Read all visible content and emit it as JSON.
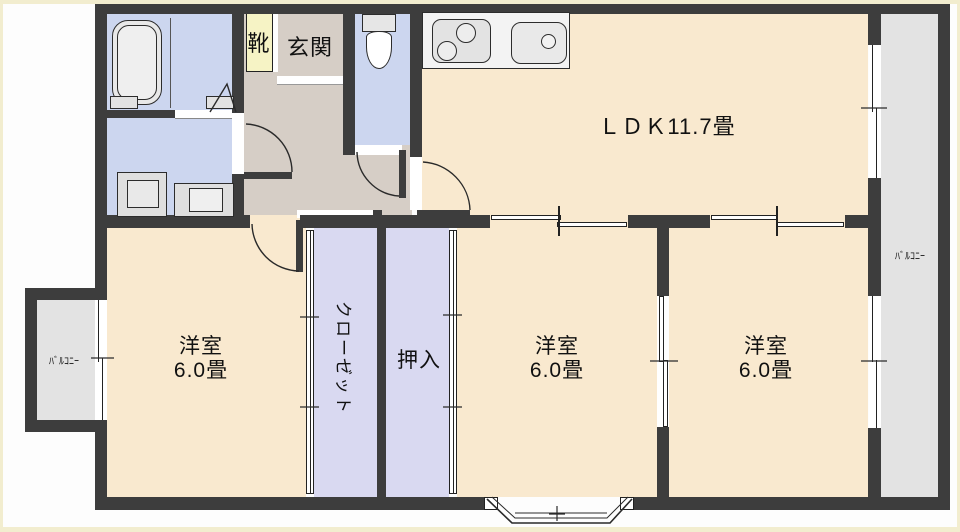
{
  "plan": {
    "type": "floor-plan",
    "rooms": {
      "ldk": {
        "label": "ＬＤＫ11.7畳"
      },
      "bedrooms": [
        {
          "name": "洋室",
          "area": "6.0畳"
        },
        {
          "name": "洋室",
          "area": "6.0畳"
        },
        {
          "name": "洋室",
          "area": "6.0畳"
        }
      ],
      "closet": {
        "label": "クローゼット"
      },
      "oshiire": {
        "label": "押入"
      },
      "genkan": {
        "label": "玄関"
      },
      "shoe_cabinet": {
        "label": "靴"
      },
      "balconies": [
        {
          "label": "ﾊﾞﾙｺﾆｰ"
        },
        {
          "label": "ﾊﾞﾙｺﾆｰ"
        }
      ]
    },
    "colors": {
      "wall": "#3d3d3d",
      "room-cream": "#f9e9cf",
      "hallway": "#d6cec6",
      "wet-blue": "#ccd6ef",
      "closet-lavender": "#d9d9f1",
      "balcony-gray": "#e3e3e3",
      "shoe-yellow": "#f6f3c5",
      "frame": "#f2edcf",
      "line": "#2a2a2a"
    }
  }
}
